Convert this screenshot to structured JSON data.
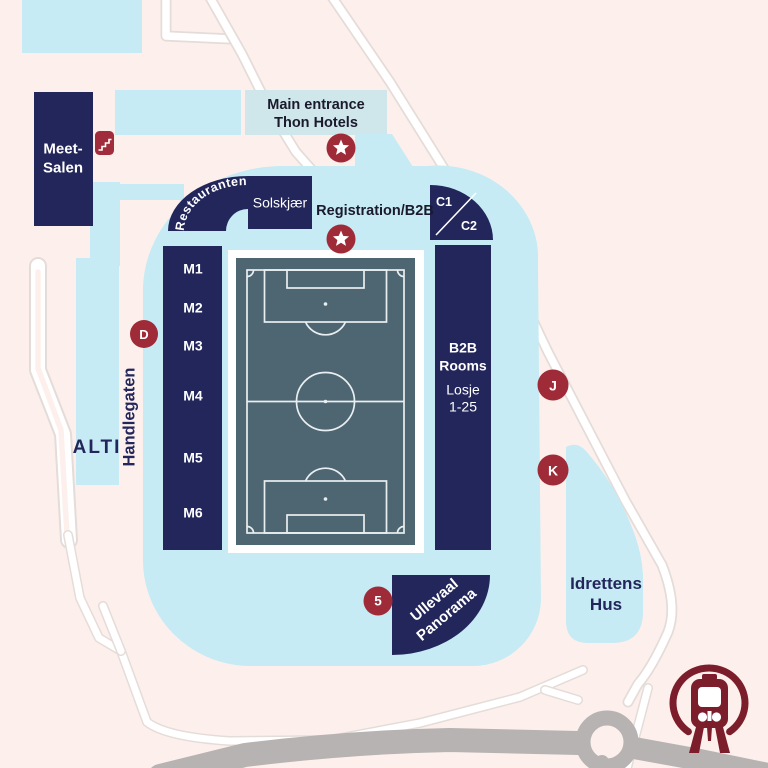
{
  "title": "Ullevaal stadium venue map",
  "colors": {
    "bg": "#fdf0ec",
    "water_blue": "#c6ebf4",
    "entrance_blue": "#cfe6eb",
    "navy": "#23265b",
    "slate": "#4e6572",
    "marker_red": "#9e2b37",
    "train_red": "#7c1d2b",
    "road_gray": "#b6b3b2",
    "text_dark": "#1a1a2c"
  },
  "buildings": {
    "meet_salen": {
      "line1": "Meet-",
      "line2": "Salen"
    },
    "main_entrance": {
      "line1": "Main entrance",
      "line2": "Thon Hotels"
    },
    "registration": {
      "label": "Registration/B2B"
    },
    "restauranten": {
      "label": "Restauranten"
    },
    "solskjaer": {
      "label": "Solskjær"
    },
    "c1": {
      "label": "C1"
    },
    "c2": {
      "label": "C2"
    },
    "meeting_rooms": [
      "M1",
      "M2",
      "M3",
      "M4",
      "M5",
      "M6"
    ],
    "b2b": {
      "line1": "B2B",
      "line2": "Rooms",
      "line3": "Losje",
      "line4": "1-25"
    },
    "alti": {
      "label": "ALTI"
    },
    "handlegaten": {
      "label": "Handlegaten"
    },
    "idrettens_hus": {
      "line1": "Idrettens",
      "line2": "Hus"
    },
    "ullevaal_panorama": {
      "line1": "Ullevaal",
      "line2": "Panorama"
    }
  },
  "markers": {
    "d": {
      "label": "D"
    },
    "j": {
      "label": "J"
    },
    "k": {
      "label": "K"
    },
    "five": {
      "label": "5"
    }
  },
  "icons": {
    "stairs": "stairs",
    "star_main_entrance": "star",
    "star_registration": "star",
    "metro": "metro-train"
  }
}
